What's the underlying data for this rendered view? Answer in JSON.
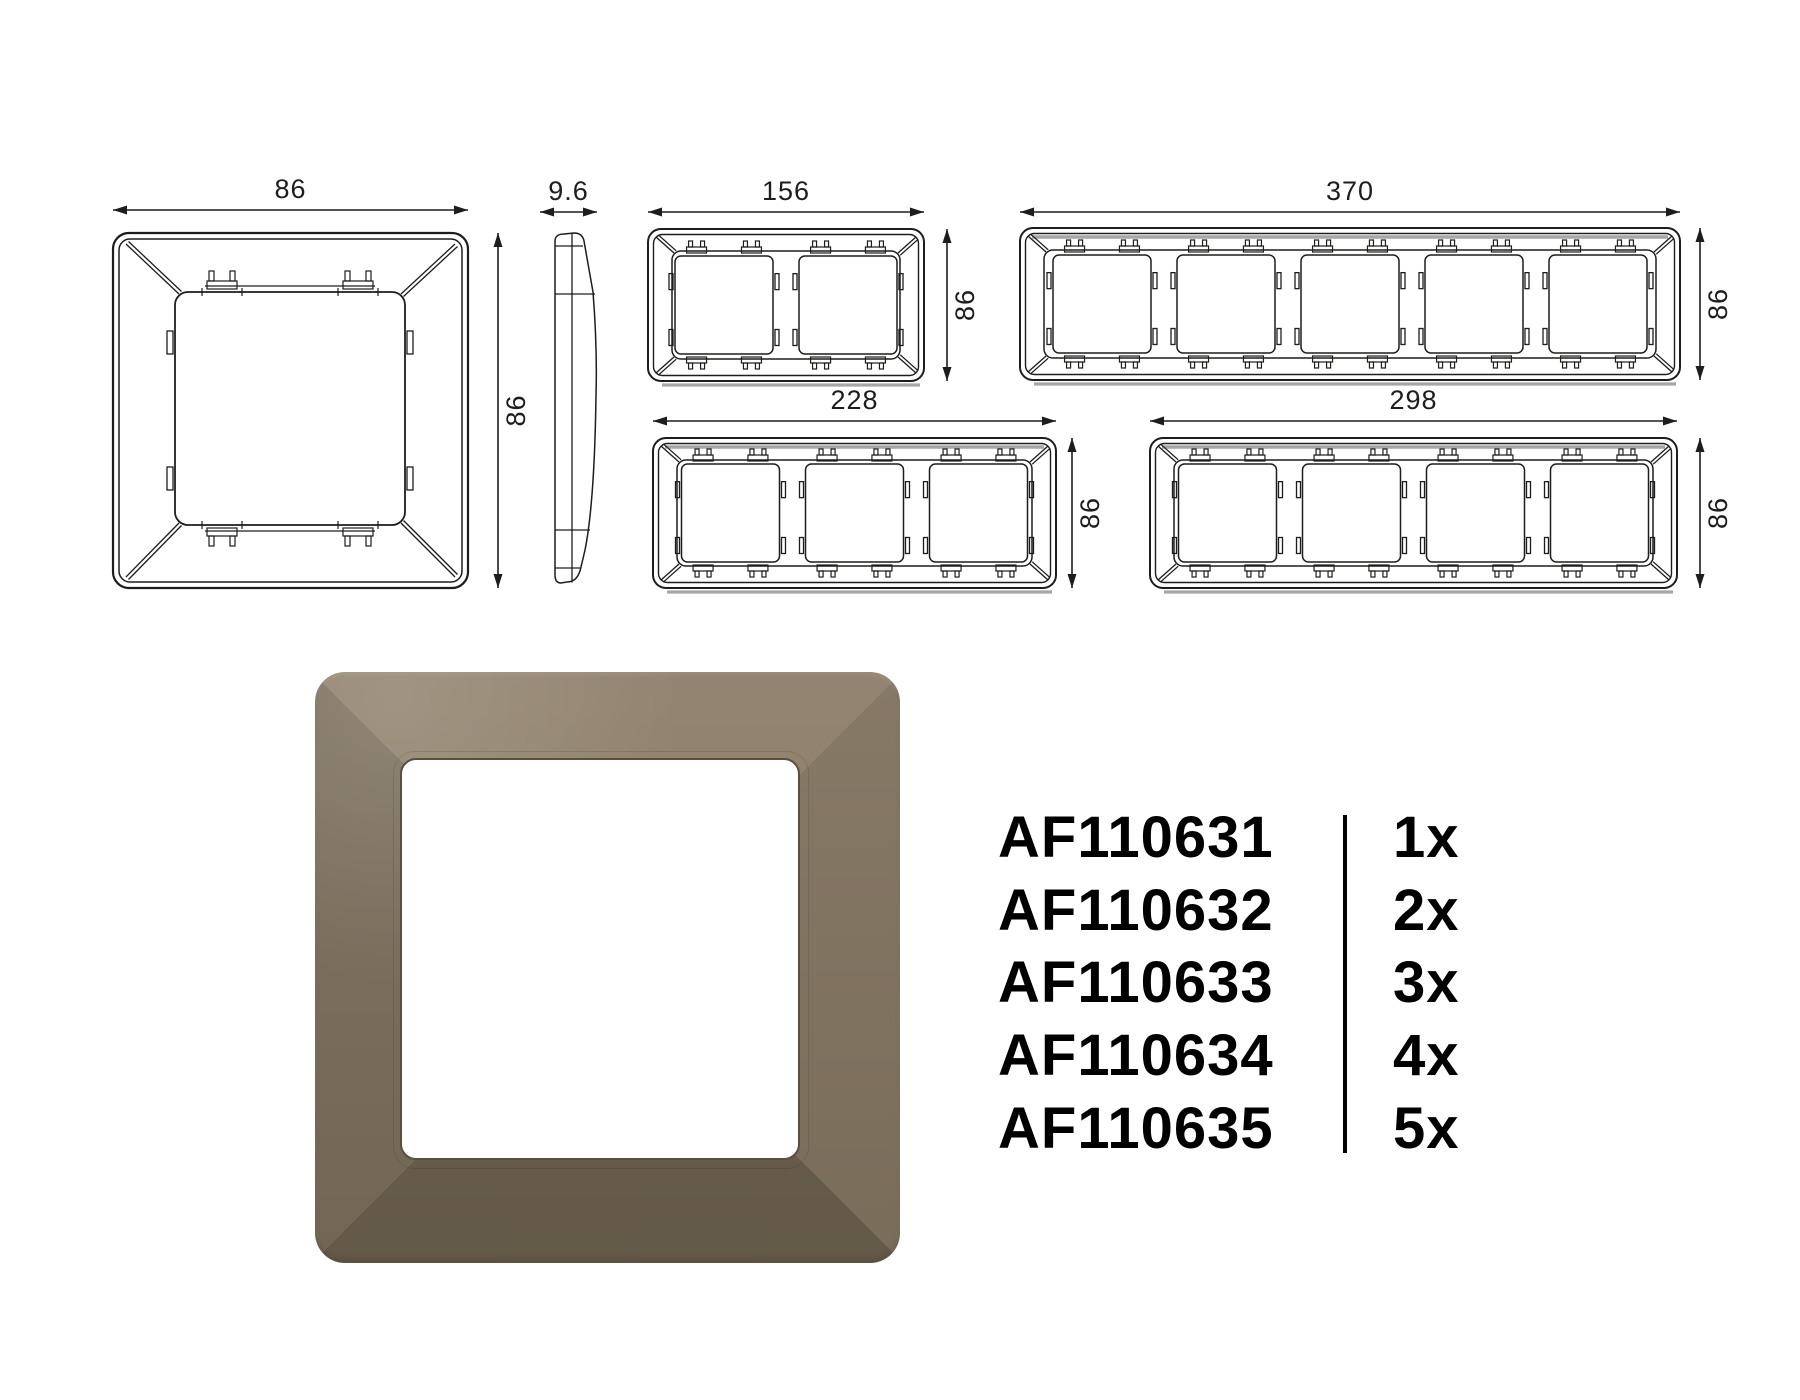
{
  "colors": {
    "line": "#1d1d1b",
    "shade_gray": "#a6a6a6",
    "product_top_facet": "#8D7E68",
    "product_right_facet": "#80725E",
    "product_bottom_facet": "#695E4C",
    "product_left_facet": "#786C59",
    "product_window": "#ffffff",
    "product_window_edge": "#584F41",
    "background": "#ffffff",
    "text": "#000000"
  },
  "drawings": [
    {
      "id": "front-1gang",
      "type": "front",
      "x": 113,
      "y": 233,
      "w": 355,
      "h": 355,
      "dim_top": {
        "label": "86",
        "line_y": 210
      },
      "dim_right": {
        "label": "86",
        "line_x": 498
      }
    },
    {
      "id": "profile-side",
      "type": "profile",
      "x": 554,
      "y": 233,
      "w": 42,
      "h": 353,
      "dim_top": {
        "label": "9.6",
        "line_y": 212,
        "x1": 540,
        "x2": 597
      }
    },
    {
      "id": "gang-2",
      "type": "gang",
      "modules": 2,
      "x": 648,
      "y": 229,
      "w": 276,
      "h": 152,
      "dim_top": {
        "label": "156",
        "line_y": 212
      },
      "dim_right": {
        "label": "86",
        "line_x": 947
      }
    },
    {
      "id": "gang-5",
      "type": "gang",
      "modules": 5,
      "x": 1020,
      "y": 228,
      "w": 660,
      "h": 152,
      "shaded": true,
      "dim_top": {
        "label": "370",
        "line_y": 212
      },
      "dim_right": {
        "label": "86",
        "line_x": 1700
      }
    },
    {
      "id": "gang-3",
      "type": "gang",
      "modules": 3,
      "x": 653,
      "y": 438,
      "w": 403,
      "h": 150,
      "shaded": true,
      "dim_top": {
        "label": "228",
        "line_y": 421
      },
      "dim_right": {
        "label": "86",
        "line_x": 1072
      }
    },
    {
      "id": "gang-4",
      "type": "gang",
      "modules": 4,
      "x": 1150,
      "y": 438,
      "w": 527,
      "h": 150,
      "shaded": true,
      "dim_top": {
        "label": "298",
        "line_y": 421
      },
      "dim_right": {
        "label": "86",
        "line_x": 1700
      }
    }
  ],
  "part_list": {
    "rows": [
      {
        "code": "AF110631",
        "qty": "1x"
      },
      {
        "code": "AF110632",
        "qty": "2x"
      },
      {
        "code": "AF110633",
        "qty": "3x"
      },
      {
        "code": "AF110634",
        "qty": "4x"
      },
      {
        "code": "AF110635",
        "qty": "5x"
      }
    ]
  }
}
